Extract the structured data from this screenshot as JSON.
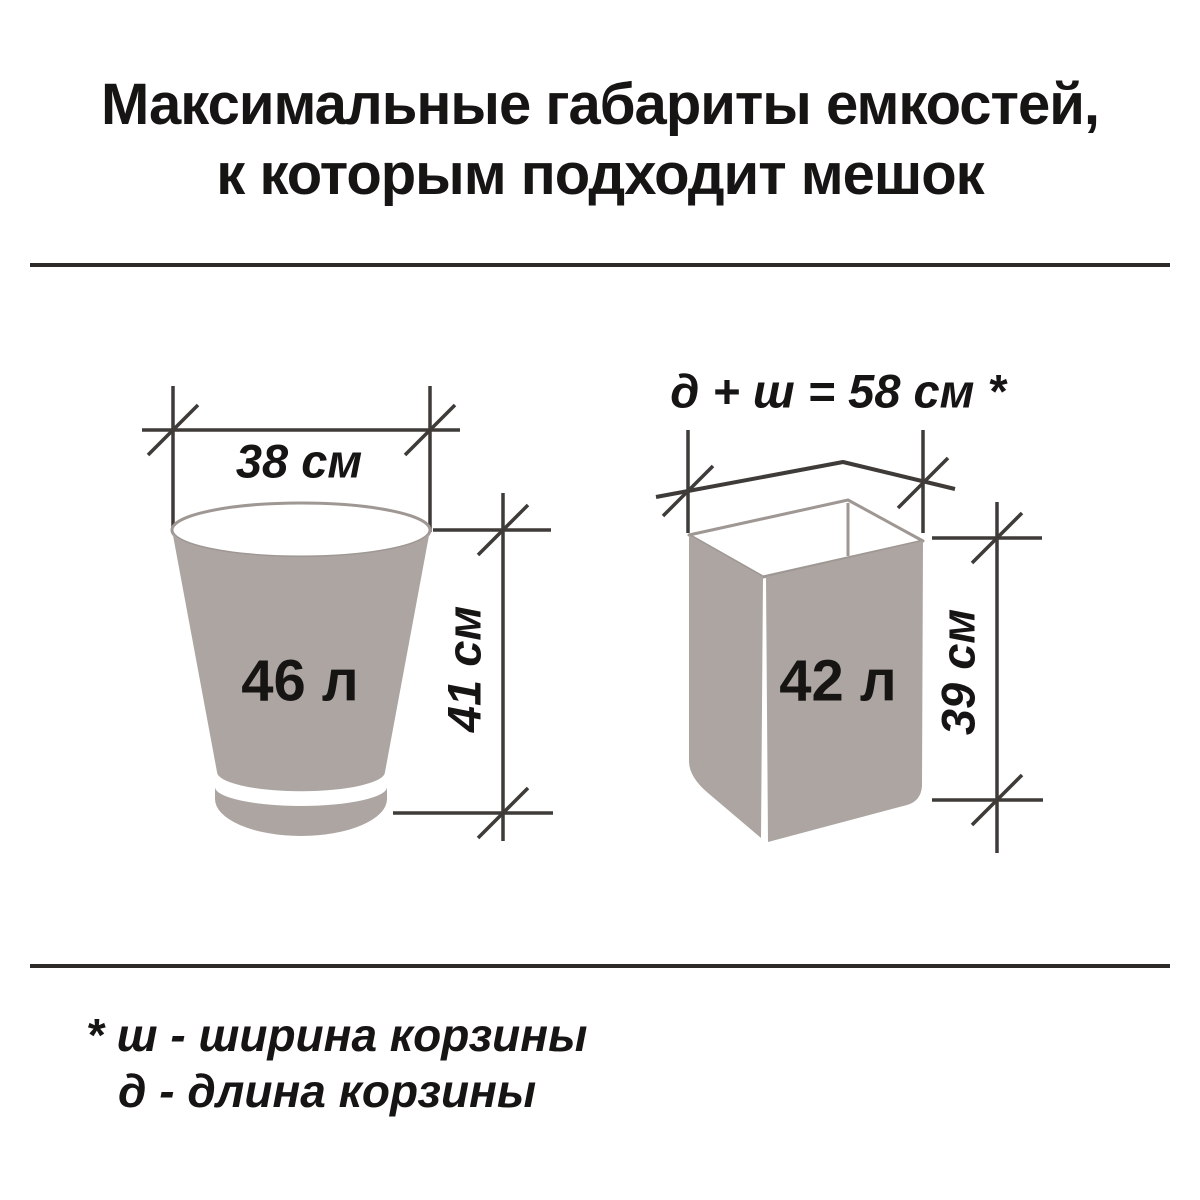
{
  "title": {
    "line1": "Максимальные габариты емкостей,",
    "line2": "к которым подходит мешок"
  },
  "bucket": {
    "diameter_label": "38 см",
    "volume_label": "46 л",
    "height_label": "41 см"
  },
  "basket": {
    "dimension_sum_label": "д + ш = 58 см *",
    "volume_label": "42 л",
    "height_label": "39 см"
  },
  "footnote": {
    "line1": "* ш - ширина корзины",
    "line2": "д  - длина корзины"
  },
  "colors": {
    "ink": "#171513",
    "container_gray": "#aca5a2",
    "rim_gray": "#9e9793",
    "line_gray": "#3f3b38",
    "background": "#ffffff"
  }
}
